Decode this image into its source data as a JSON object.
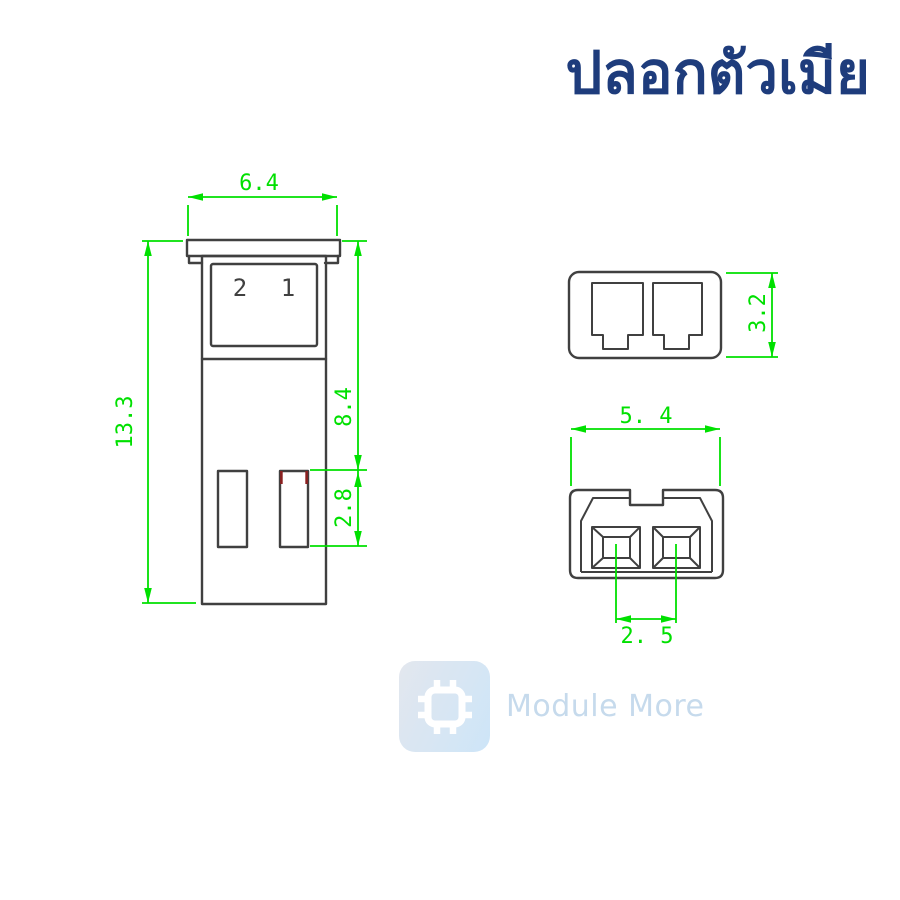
{
  "title": "ปลอกตัวเมีย",
  "colors": {
    "dimension": "#00e000",
    "line": "#404040",
    "title": "#1e3c7c",
    "red_mark": "#8b2020",
    "watermark_text": "#c3d9ec",
    "tile_start": "#e2e6ee",
    "tile_end": "#cbe4f8"
  },
  "front_view": {
    "pin_label_left": "2",
    "pin_label_right": "1",
    "dim_width": "6.4",
    "dim_height": "13.3",
    "dim_upper_height": "8.4",
    "dim_slot_height": "2.8"
  },
  "top_view": {
    "dim_height": "3.2"
  },
  "bottom_view": {
    "dim_width": "5. 4",
    "dim_pin_pitch": "2. 5"
  },
  "watermark": {
    "brand": "Module More"
  }
}
